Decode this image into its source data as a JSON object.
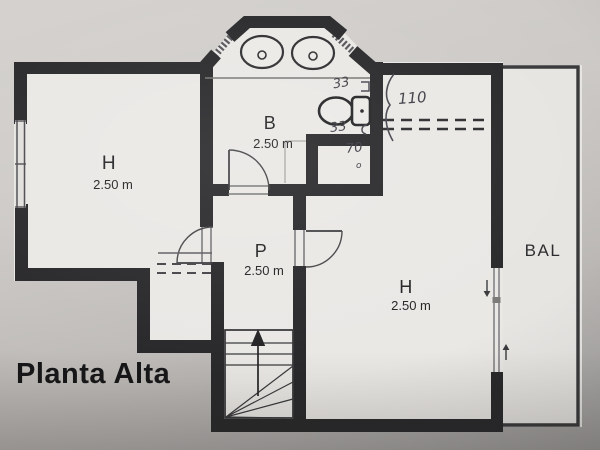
{
  "title": "Planta Alta",
  "rooms": [
    {
      "id": "h_left",
      "label": "H",
      "size": "2.50 m"
    },
    {
      "id": "b",
      "label": "B",
      "size": "2.50 m"
    },
    {
      "id": "p",
      "label": "P",
      "size": "2.50 m"
    },
    {
      "id": "h_right",
      "label": "H",
      "size": "2.50 m"
    }
  ],
  "balcony": {
    "label": "BAL"
  },
  "annotations": {
    "toilet_top": "33",
    "toilet_bottom": "33",
    "shower_width": "70",
    "shower_sub": "o",
    "window_height": "110"
  },
  "colors": {
    "wall": "#28282a",
    "paper_room": "#eae8e5",
    "paper_background": "#c9c6c3",
    "printed_ink": "#232325",
    "pencil_ink": "#3c3c44"
  }
}
